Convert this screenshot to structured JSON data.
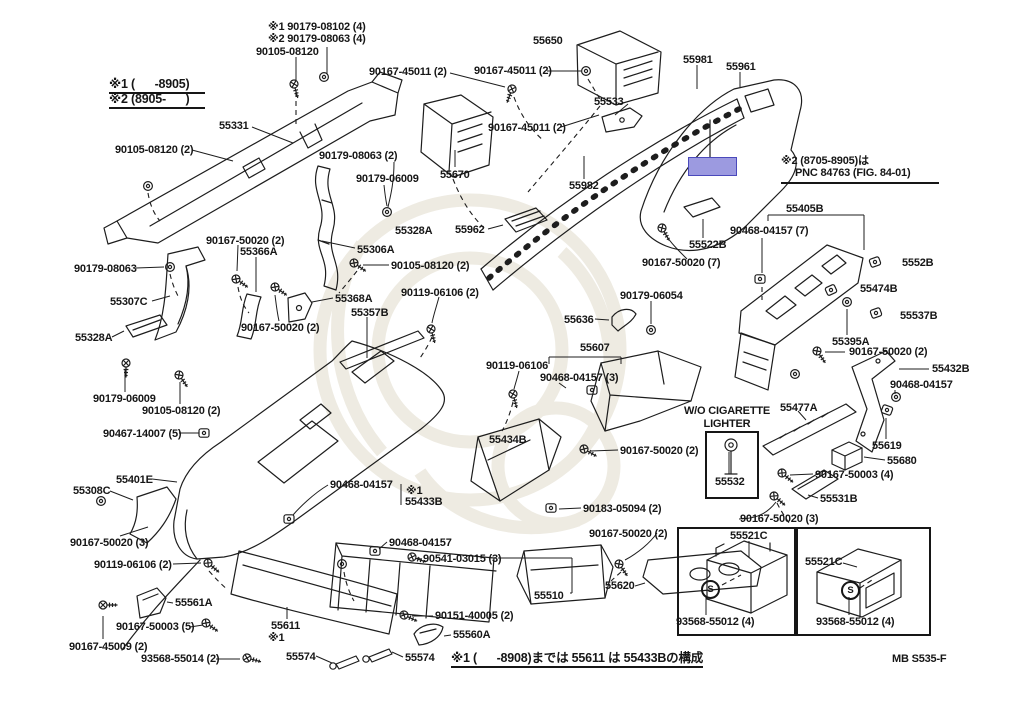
{
  "figure": {
    "code": "MB S535-F",
    "highlight_color": "#9c9ae0"
  },
  "notes": {
    "top1": "※1 90179-08102 (4)",
    "top2": "※2 90179-08063 (4)",
    "legend1": "※1 (      -8905)",
    "legend2": "※2 (8905-      )",
    "pnc1": "※2 (8705-8905)は",
    "pnc2": "PNC 84763 (FIG. 84-01)",
    "wo1": "W/O CIGARETTE",
    "wo2": "LIGHTER",
    "bottom": "※1 (      -8908)までは 55611 は 55433Bの構成",
    "s_mark": "S"
  },
  "parts": [
    "90105-08120",
    "55650",
    "55981",
    "55961",
    "90167-45011 (2)",
    "90167-45011 (2)",
    "55331",
    "90167-45011 (2)",
    "55533",
    "90105-08120 (2)",
    "90179-08063 (2)",
    "90179-06009",
    "55670",
    "55982",
    "55405B",
    "90468-04157 (7)",
    "55962",
    "55522B",
    "90167-50020 (7)",
    "90179-08063",
    "90167-50020 (2)",
    "55366A",
    "55306A",
    "90105-08120 (2)",
    "55328A",
    "55307C",
    "55368A",
    "90119-06106 (2)",
    "55357B",
    "55328A",
    "90167-50020 (2)",
    "90179-06009",
    "90105-08120 (2)",
    "90119-06106",
    "55607",
    "90468-04157 (3)",
    "55636",
    "90179-06054",
    "55434B",
    "90167-50020 (2)",
    "55532",
    "55395A",
    "90167-50020 (2)",
    "55432B",
    "90468-04157",
    "55477A",
    "5552B",
    "55474B",
    "55537B",
    "55619",
    "55680",
    "90167-50003 (4)",
    "55531B",
    "90167-50020 (3)",
    "90467-14007 (5)",
    "55401E",
    "55308C",
    "90468-04157",
    "※1",
    "55433B",
    "90167-50020 (3)",
    "90119-06106 (2)",
    "90468-04157",
    "90541-03015 (3)",
    "90183-05094 (2)",
    "90167-50020 (2)",
    "55620",
    "55510",
    "55561A",
    "90167-50003 (5)",
    "90167-45009 (2)",
    "93568-55014 (2)",
    "55611",
    "※1",
    "55574",
    "55574",
    "55560A",
    "90151-40005 (2)",
    "55521C",
    "55521C",
    "93568-55012 (4)",
    "93568-55012 (4)"
  ]
}
